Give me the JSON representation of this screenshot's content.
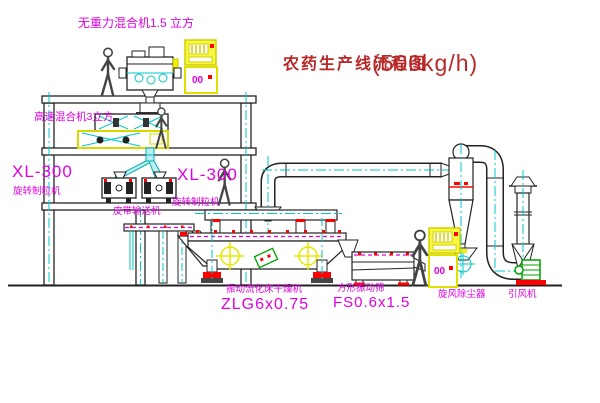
{
  "title": {
    "name": "农药生产线流程图",
    "capacity": "(500kg/h)"
  },
  "equipment_labels": {
    "gravity_mixer": "无重力混合机1.5 立方",
    "high_speed_mixer": "高速混合机3立方",
    "granulator_left_model": "XL-300",
    "granulator_left_name": "旋转制粒机",
    "granulator_right_model": "XL-300",
    "granulator_right_name": "旋转制粒机",
    "belt_conveyor": "皮带输送机",
    "fluid_bed_dryer_name": "振动流化床干燥机",
    "fluid_bed_dryer_model": "ZLG6x0.75",
    "vibrating_screen_name": "方形振动筛",
    "vibrating_screen_model": "FS0.6x1.5",
    "cyclone_collector": "旋风除尘器",
    "induced_draft_fan": "引风机"
  },
  "control_panels": {
    "left_display": "00",
    "right_display": "00"
  },
  "colors": {
    "label_magenta": "#e000e0",
    "title_red": "#b82828",
    "centerline_cyan": "#00c8c8",
    "line_dark": "#2a2a2a",
    "cabinet_yellow": "#f0f000",
    "accent_red": "#ff0000",
    "fan_green": "#00a000"
  }
}
